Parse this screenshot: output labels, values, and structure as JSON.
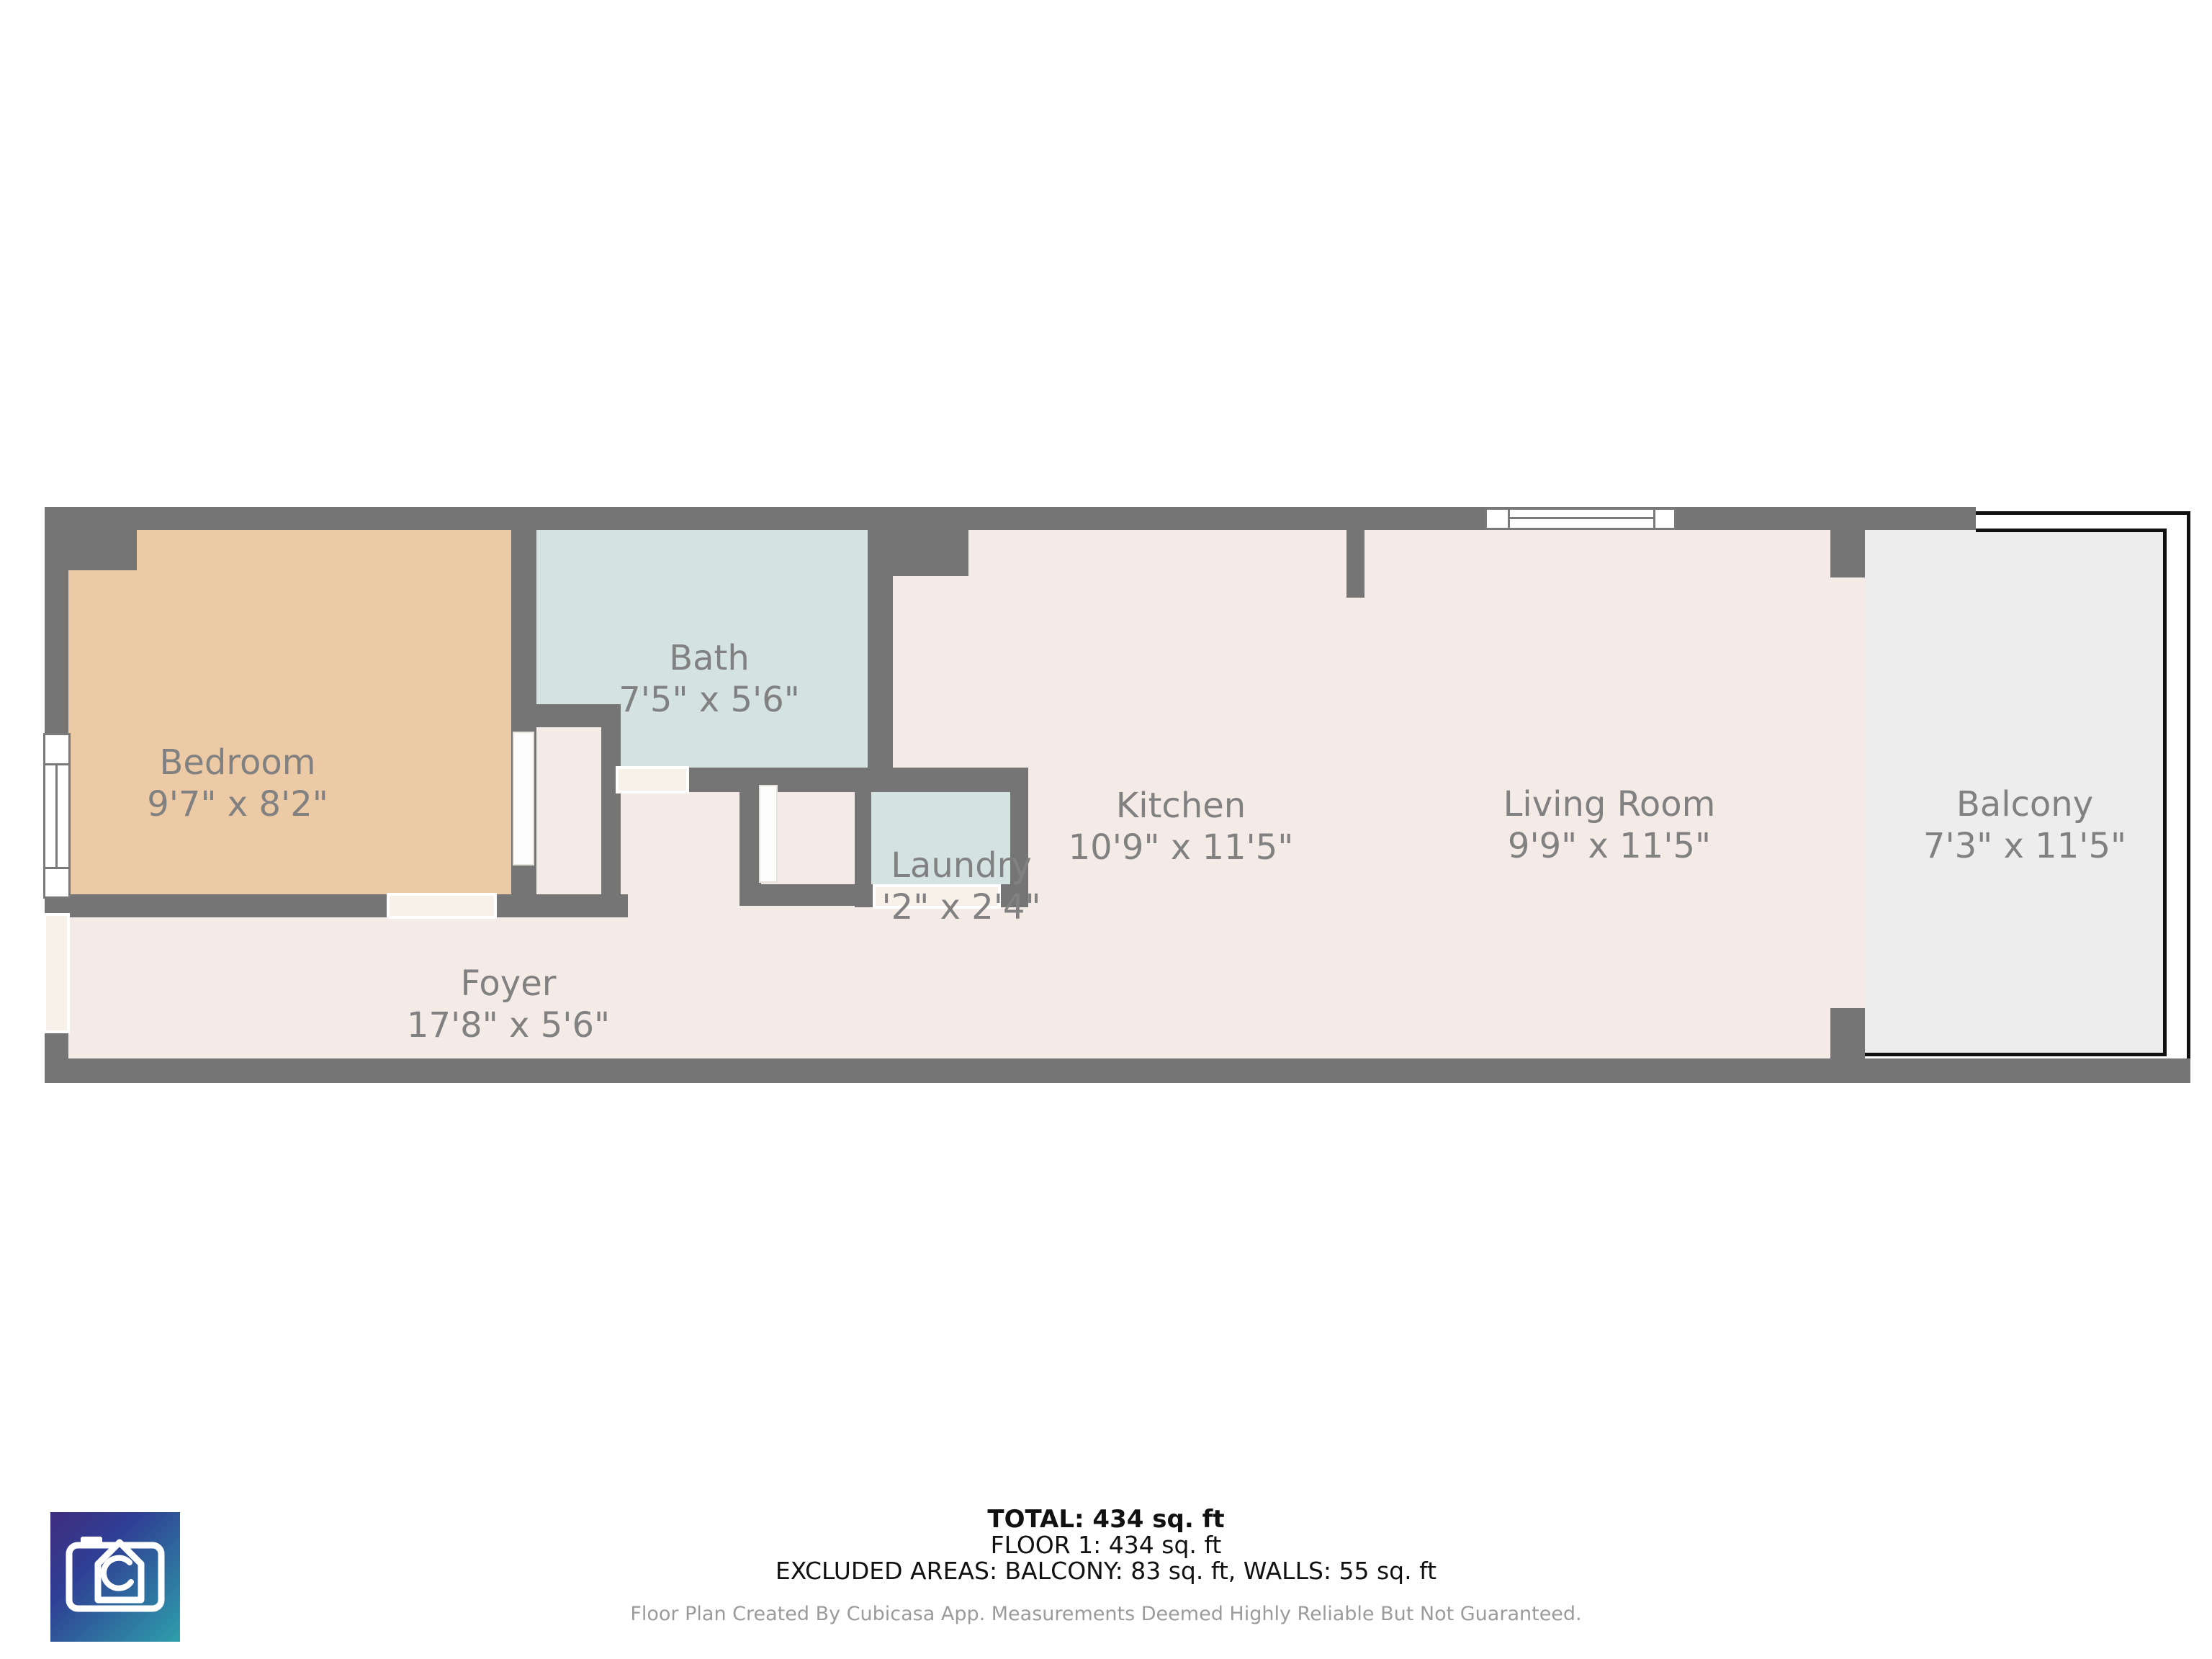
{
  "rooms": {
    "bedroom": {
      "name": "Bedroom",
      "dims": "9'7\" x 8'2\""
    },
    "bath": {
      "name": "Bath",
      "dims": "7'5\" x 5'6\""
    },
    "laundry": {
      "name": "Laundry",
      "dims": "'2\" x 2'4\""
    },
    "kitchen": {
      "name": "Kitchen",
      "dims": "10'9\" x 11'5\""
    },
    "living_room": {
      "name": "Living Room",
      "dims": "9'9\" x 11'5\""
    },
    "balcony": {
      "name": "Balcony",
      "dims": "7'3\" x 11'5\""
    },
    "foyer": {
      "name": "Foyer",
      "dims": "17'8\" x 5'6\""
    }
  },
  "summary": {
    "total": "TOTAL: 434 sq. ft",
    "floor": "FLOOR 1: 434 sq. ft",
    "excluded": "EXCLUDED AREAS: BALCONY: 83 sq. ft, WALLS: 55 sq. ft"
  },
  "footer": "Floor Plan Created By Cubicasa App. Measurements Deemed Highly Reliable But Not Guaranteed.",
  "colors": {
    "wall": "#757575",
    "floor": "#f5ebe6",
    "bedroom_fill": "#edcaa6",
    "wet_room_fill": "#d4e2e1",
    "balcony_fill": "#ededed",
    "label_text": "#818181",
    "logo_gradient_start": "#3f2d80",
    "logo_gradient_end": "#2e9fab"
  }
}
